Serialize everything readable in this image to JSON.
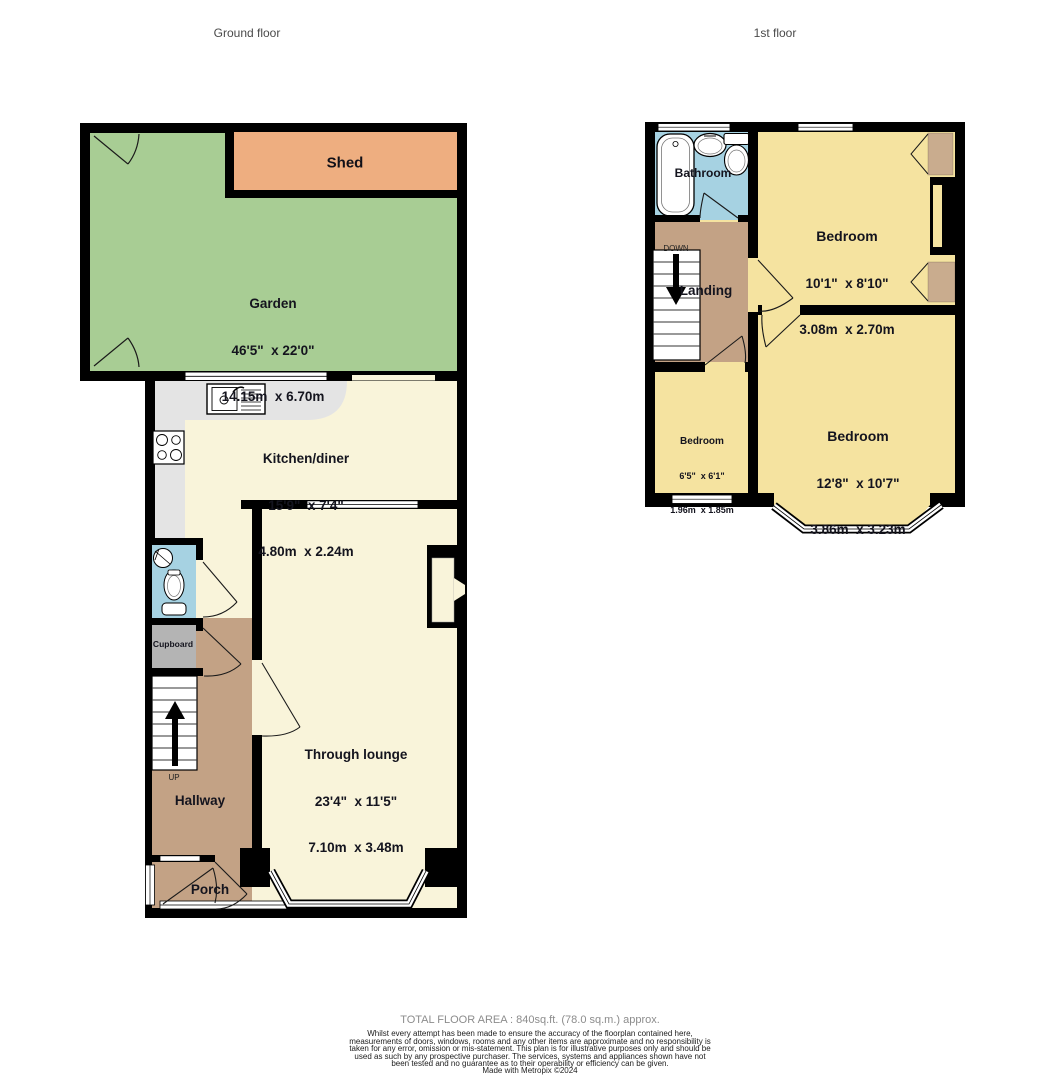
{
  "header": {
    "ground_floor_label": "Ground floor",
    "first_floor_label": "1st floor"
  },
  "ground_floor": {
    "garden": {
      "name": "Garden",
      "imperial": "46'5\"  x 22'0\"",
      "metric": "14.15m  x 6.70m"
    },
    "shed": {
      "name": "Shed"
    },
    "kitchen": {
      "name": "Kitchen/diner",
      "imperial": "15'9\"  x 7'4\"",
      "metric": "4.80m  x 2.24m"
    },
    "lounge": {
      "name": "Through lounge",
      "imperial": "23'4\"  x 11'5\"",
      "metric": "7.10m  x 3.48m"
    },
    "hallway": {
      "name": "Hallway"
    },
    "porch": {
      "name": "Porch"
    },
    "cupboard": {
      "name": "Cupboard"
    },
    "stairs_label": "UP"
  },
  "first_floor": {
    "bathroom": {
      "name": "Bathroom"
    },
    "landing": {
      "name": "Landing"
    },
    "stairs_label": "DOWN",
    "bedroom1": {
      "name": "Bedroom",
      "imperial": "10'1\"  x 8'10\"",
      "metric": "3.08m  x 2.70m"
    },
    "bedroom2": {
      "name": "Bedroom",
      "imperial": "12'8\"  x 10'7\"",
      "metric": "3.86m  x 3.23m"
    },
    "bedroom3": {
      "name": "Bedroom",
      "imperial": "6'5\"  x 6'1\"",
      "metric": "1.96m  x 1.85m"
    }
  },
  "footer": {
    "total_area": "TOTAL FLOOR AREA : 840sq.ft. (78.0 sq.m.) approx.",
    "disclaimer": "Whilst every attempt has been made to ensure the accuracy of the floorplan contained here, measurements of doors, windows, rooms and any other items are approximate and no responsibility is taken for any error, omission or mis-statement. This plan is for illustrative purposes only and should be used as such by any prospective purchaser. The services, systems and appliances shown have not been tested and no guarantee as to their operability or efficiency can be given.",
    "credit": "Made with Metropix ©2024"
  },
  "colors": {
    "wall": "#000000",
    "garden_green": "#a8cd94",
    "shed_orange": "#eeae80",
    "room_cream": "#f9f4da",
    "bedroom_yellow": "#f5e3a0",
    "circulation_tan": "#c3a285",
    "wardrobe_tan": "#c9ac8e",
    "bathroom_blue": "#a6d2e2",
    "counter_gray": "#e4e4e4",
    "cupboard_gray": "#b4b4b4",
    "label_ink": "#14141e"
  }
}
